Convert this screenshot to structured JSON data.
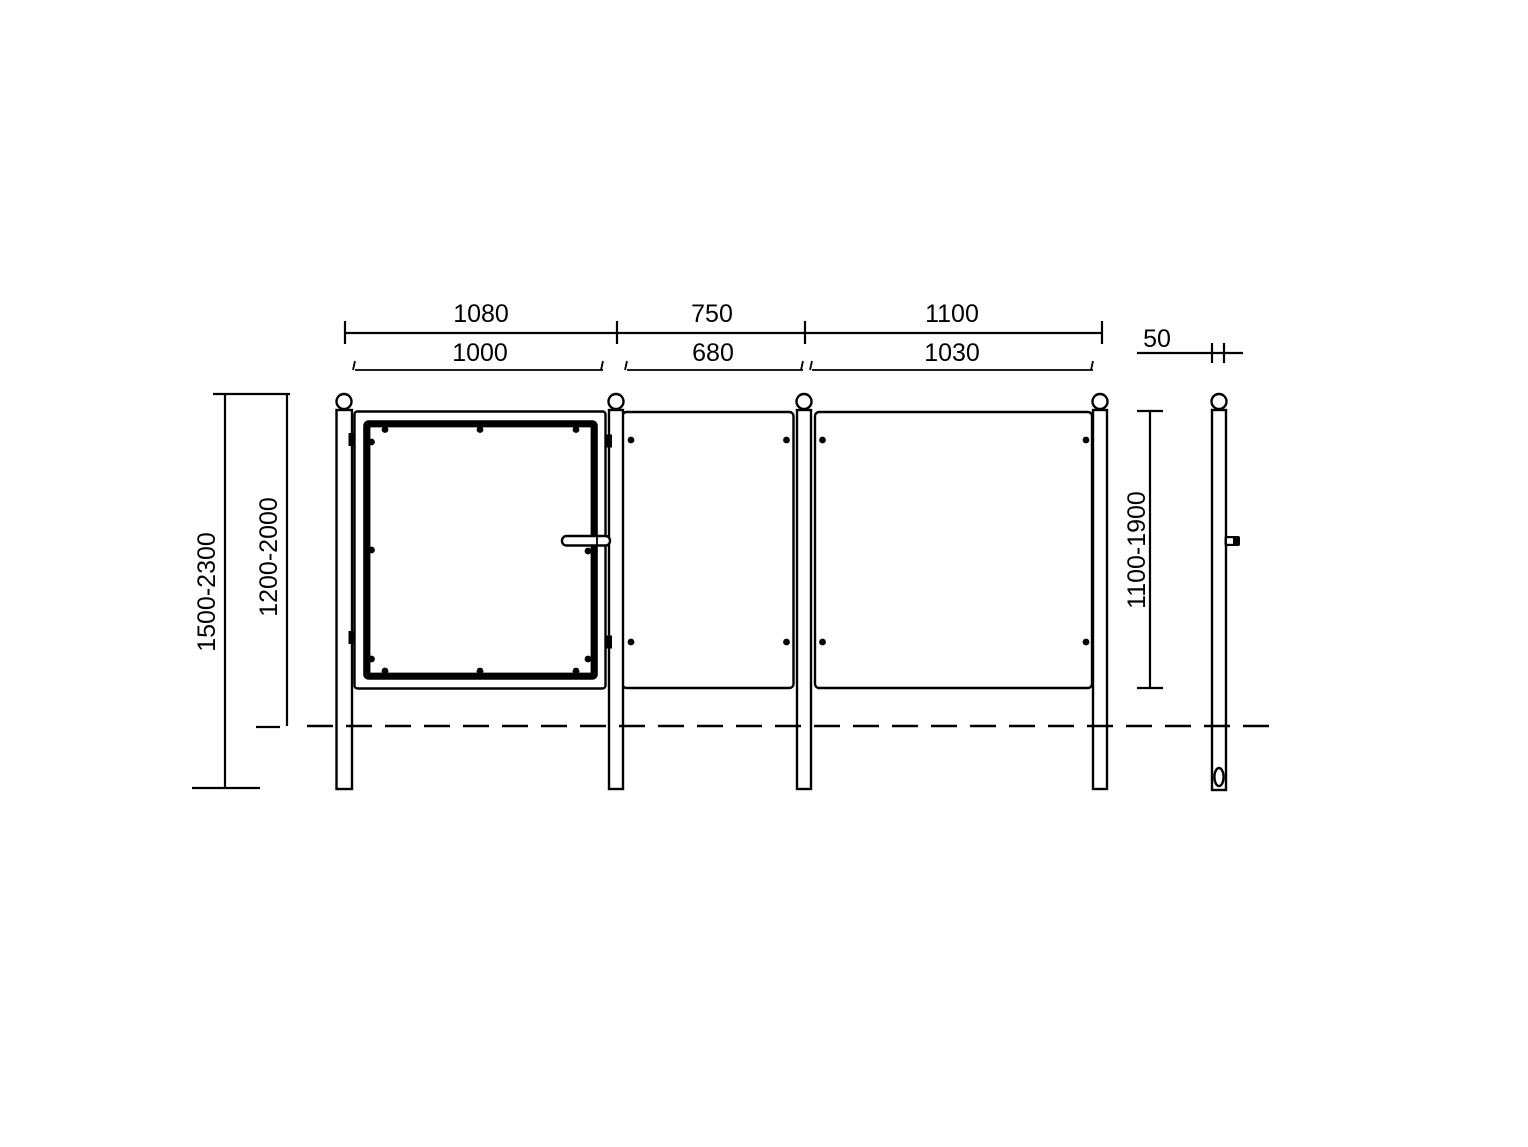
{
  "drawing": {
    "type": "technical dimension drawing - fence with gate, front and side view",
    "horizontal_dimensions": {
      "outer": {
        "span1": "1080",
        "span2": "750",
        "span3": "1100"
      },
      "inner": {
        "span1": "1000",
        "span2": "680",
        "span3": "1030"
      }
    },
    "vertical_dimensions": {
      "total_height": "1500-2300",
      "above_ground_height": "1200-2000",
      "panel_height": "1100-1900"
    },
    "post_width": "50",
    "colors": {
      "line": "#000000",
      "background": "#ffffff"
    }
  }
}
